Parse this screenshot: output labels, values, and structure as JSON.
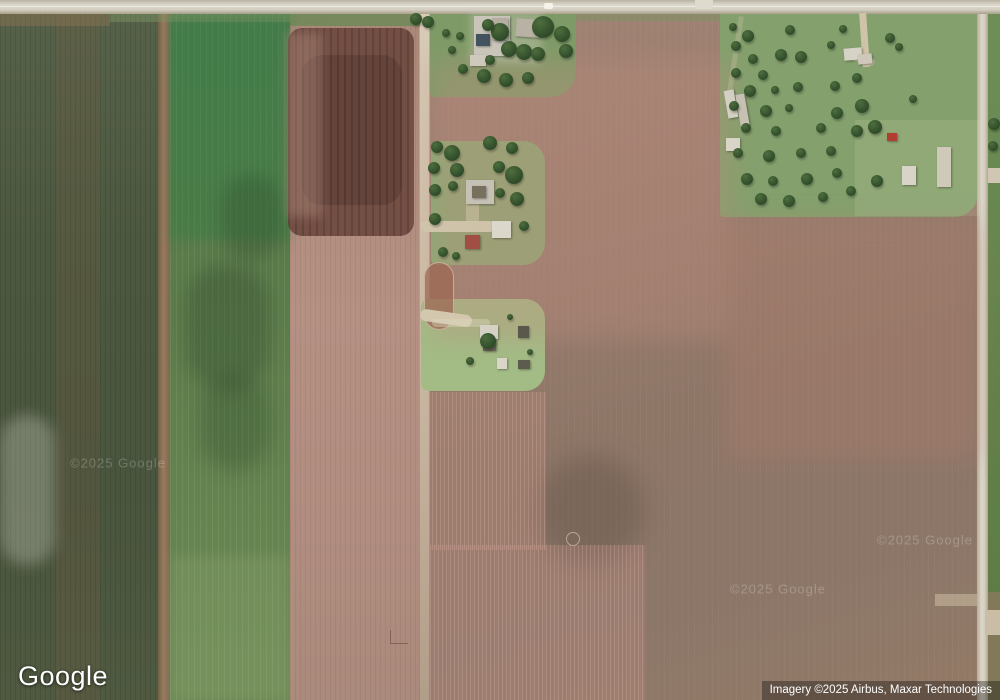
{
  "app": {
    "name": "Google Maps satellite view"
  },
  "branding": {
    "logo_text": "Google"
  },
  "attribution": {
    "text": "Imagery ©2025 Airbus, Maxar Technologies"
  },
  "watermark": {
    "text": "©2025 Google",
    "instances": [
      {
        "x": 118,
        "y": 463
      },
      {
        "x": 778,
        "y": 589
      },
      {
        "x": 925,
        "y": 540
      }
    ]
  },
  "palette": {
    "dark_green_field": "#4c583f",
    "bright_green_field": "#4e7b4e",
    "pink_tilled_field": "#b59184",
    "dark_tilled_patch": "#6f4a40",
    "big_brown_field": "#8e7667",
    "pasture_green": "#84a06d",
    "lawn_green": "#8caa74",
    "road_gray": "#d3cec0",
    "tree_green": "#2e4a28",
    "red_barn": "#a14f45",
    "attribution_bg": "rgba(0,0,0,0.33)",
    "text_white": "#ffffff"
  },
  "scene": {
    "patches": [
      {
        "name": "top-road-margin-brown",
        "x": 0,
        "y": 14,
        "w": 110,
        "h": 12,
        "color": "rgba(150,120,85,.40)"
      },
      {
        "name": "top-road-margin-green",
        "x": 110,
        "y": 14,
        "w": 190,
        "h": 8,
        "color": "rgba(125,150,100,.45)"
      },
      {
        "name": "field-c-top-green-strip",
        "x": 290,
        "y": 14,
        "w": 130,
        "h": 12,
        "color": "rgba(108,138,86,.8)"
      },
      {
        "name": "field-d-top-green-strip",
        "x": 576,
        "y": 14,
        "w": 144,
        "h": 7,
        "color": "rgba(120,148,95,.5)"
      },
      {
        "name": "cloud-smudge",
        "x": 0,
        "y": 415,
        "w": 55,
        "h": 150,
        "color": "rgba(230,235,220,.28)",
        "radius": 40,
        "blur": 7
      },
      {
        "name": "field-b-bright-top",
        "x": 170,
        "y": 20,
        "w": 120,
        "h": 220,
        "color": "rgba(44,125,66,.35)",
        "blur": 5
      },
      {
        "name": "field-b-dark-blotch",
        "x": 185,
        "y": 265,
        "w": 85,
        "h": 125,
        "color": "rgba(35,60,35,.30)",
        "radius": 40,
        "blur": 9
      },
      {
        "name": "field-b-dark-blotch",
        "x": 200,
        "y": 375,
        "w": 70,
        "h": 95,
        "color": "rgba(35,60,35,.26)",
        "radius": 40,
        "blur": 9
      },
      {
        "name": "field-b-dark-blotch",
        "x": 222,
        "y": 175,
        "w": 60,
        "h": 85,
        "color": "rgba(35,60,35,.25)",
        "radius": 40,
        "blur": 8
      },
      {
        "name": "field-b-pale-bottom",
        "x": 170,
        "y": 555,
        "w": 120,
        "h": 145,
        "color": "rgba(190,200,150,.14)",
        "blur": 6
      },
      {
        "name": "dark-tilled-patch",
        "x": 288,
        "y": 28,
        "w": 126,
        "h": 208,
        "color": "#6f4a40",
        "radius": 14,
        "opacity": 0.92,
        "cls": "streaksDark"
      },
      {
        "name": "dark-tilled-patch-core",
        "x": 302,
        "y": 55,
        "w": 100,
        "h": 150,
        "color": "#5c3d36",
        "radius": 20,
        "opacity": 0.6,
        "cls": "streaksDark"
      },
      {
        "name": "dark-patch-left-blend",
        "x": 286,
        "y": 32,
        "w": 36,
        "h": 185,
        "color": "rgba(179,144,131,.40)",
        "blur": 5
      },
      {
        "name": "field-d-pink-topleft",
        "x": 432,
        "y": 60,
        "w": 300,
        "h": 280,
        "color": "rgba(190,140,124,.33)",
        "blur": 12
      },
      {
        "name": "field-d-red-right",
        "x": 725,
        "y": 220,
        "w": 255,
        "h": 240,
        "color": "rgba(178,126,110,.30)",
        "blur": 12
      },
      {
        "name": "field-d-dark-smudge",
        "x": 535,
        "y": 455,
        "w": 110,
        "h": 110,
        "color": "rgba(60,48,42,.22)",
        "radius": 55,
        "blur": 12
      },
      {
        "name": "field-d-circle-mark",
        "x": 566,
        "y": 532,
        "w": 14,
        "h": 14,
        "color": "transparent",
        "radius": 7,
        "cls": "ringLight"
      },
      {
        "name": "field-d-pink-rows-bottom",
        "x": 430,
        "y": 545,
        "w": 215,
        "h": 155,
        "color": "rgba(200,152,140,.22)",
        "cls": "pinkRows"
      },
      {
        "name": "field-d-pink-rows-mid",
        "x": 428,
        "y": 392,
        "w": 118,
        "h": 158,
        "color": "rgba(190,145,132,.26)",
        "cls": "pinkRows"
      },
      {
        "name": "pasture-light-right",
        "x": 855,
        "y": 120,
        "w": 125,
        "h": 96,
        "color": "rgba(255,255,220,.10)"
      },
      {
        "name": "right-sliver-bottom-brown",
        "x": 988,
        "y": 592,
        "w": 12,
        "h": 108,
        "color": "rgba(135,121,92,.85)"
      },
      {
        "name": "h2-red-dirt-patch",
        "x": 424,
        "y": 262,
        "w": 30,
        "h": 68,
        "color": "rgba(158,104,84,.75)",
        "radius": 15,
        "cls": "ringLight"
      },
      {
        "name": "l-shaped-mark",
        "x": 390,
        "y": 630,
        "w": 18,
        "h": 14,
        "color": "transparent",
        "cls": "lmark"
      },
      {
        "name": "road-junction-stub",
        "x": 695,
        "y": 0,
        "w": 18,
        "h": 9,
        "color": "#dedacd"
      },
      {
        "name": "east-road-branch-left",
        "x": 935,
        "y": 594,
        "w": 42,
        "h": 12,
        "color": "rgba(205,190,165,.55)"
      },
      {
        "name": "east-road-driveway-upper",
        "x": 988,
        "y": 168,
        "w": 12,
        "h": 15,
        "color": "#cfc7b4"
      },
      {
        "name": "east-road-driveway-lower",
        "x": 985,
        "y": 610,
        "w": 15,
        "h": 25,
        "color": "#c9bda6"
      },
      {
        "name": "vehicle-on-road",
        "x": 544,
        "y": 3,
        "w": 9,
        "h": 6,
        "color": "#f5f3ea",
        "radius": 2
      },
      {
        "name": "pasture-trail",
        "x": 733,
        "y": 16,
        "w": 5,
        "h": 76,
        "color": "rgba(200,190,160,.35)",
        "rot": 9
      },
      {
        "name": "pasture-driveway",
        "x": 861,
        "y": 13,
        "w": 7,
        "h": 54,
        "color": "#cfc4a8",
        "rot": -4
      },
      {
        "name": "pasture-driveway-spur",
        "x": 848,
        "y": 55,
        "w": 27,
        "h": 8,
        "color": "rgba(207,196,168,.8)",
        "rot": 18,
        "radius": 4
      },
      {
        "name": "h1-ground-patch",
        "x": 470,
        "y": 12,
        "w": 72,
        "h": 52,
        "color": "rgba(212,207,192,.35)",
        "blur": 4
      },
      {
        "name": "h2-driveway",
        "x": 420,
        "y": 221,
        "w": 75,
        "h": 11,
        "color": "#cfc3a9",
        "radius": 6
      },
      {
        "name": "h2-driveway-vert",
        "x": 466,
        "y": 196,
        "w": 13,
        "h": 30,
        "color": "rgba(205,193,165,.55)",
        "radius": 4
      },
      {
        "name": "h3-driveway",
        "x": 420,
        "y": 312,
        "w": 52,
        "h": 12,
        "color": "#d3c8ae",
        "radius": 8,
        "rot": 8
      },
      {
        "name": "h3-driveway-streak",
        "x": 432,
        "y": 319,
        "w": 58,
        "h": 8,
        "color": "rgba(222,217,192,.40)",
        "radius": 4
      }
    ],
    "buildings": [
      {
        "x": 474,
        "y": 16,
        "w": 36,
        "h": 40,
        "color": "#c9c5b9"
      },
      {
        "x": 492,
        "y": 18,
        "w": 16,
        "h": 22,
        "color": "#b5aea0"
      },
      {
        "x": 476,
        "y": 34,
        "w": 14,
        "h": 12,
        "color": "#42525f"
      },
      {
        "x": 516,
        "y": 19,
        "w": 24,
        "h": 18,
        "color": "#b8b2a4",
        "rot": 4
      },
      {
        "x": 470,
        "y": 55,
        "w": 16,
        "h": 11,
        "color": "#cfc9bb"
      },
      {
        "x": 466,
        "y": 180,
        "w": 28,
        "h": 24,
        "color": "#c6c1b5"
      },
      {
        "x": 472,
        "y": 186,
        "w": 14,
        "h": 12,
        "color": "#77705f"
      },
      {
        "x": 492,
        "y": 221,
        "w": 19,
        "h": 17,
        "color": "#dbd7cb"
      },
      {
        "x": 465,
        "y": 235,
        "w": 15,
        "h": 14,
        "color": "#a14f45"
      },
      {
        "x": 480,
        "y": 325,
        "w": 18,
        "h": 14,
        "color": "#d5d1c5"
      },
      {
        "x": 483,
        "y": 339,
        "w": 13,
        "h": 12,
        "color": "#6b6458"
      },
      {
        "x": 497,
        "y": 358,
        "w": 10,
        "h": 11,
        "color": "#d9d5c9"
      },
      {
        "x": 518,
        "y": 326,
        "w": 11,
        "h": 12,
        "color": "#5a574b"
      },
      {
        "x": 518,
        "y": 360,
        "w": 12,
        "h": 9,
        "color": "#5d5a4e"
      },
      {
        "x": 726,
        "y": 90,
        "w": 10,
        "h": 28,
        "color": "#d3cfc3",
        "rot": -10
      },
      {
        "x": 738,
        "y": 94,
        "w": 9,
        "h": 32,
        "color": "#c6c1b3",
        "rot": -10
      },
      {
        "x": 726,
        "y": 138,
        "w": 14,
        "h": 13,
        "color": "#d8d4c8"
      },
      {
        "x": 844,
        "y": 48,
        "w": 18,
        "h": 12,
        "color": "#d6d2c6",
        "rot": -5
      },
      {
        "x": 858,
        "y": 54,
        "w": 14,
        "h": 10,
        "color": "#cdc8ba",
        "rot": -5
      },
      {
        "x": 902,
        "y": 166,
        "w": 14,
        "h": 19,
        "color": "#d8d4c8"
      },
      {
        "x": 937,
        "y": 147,
        "w": 14,
        "h": 40,
        "color": "#cfc9b8"
      },
      {
        "x": 887,
        "y": 133,
        "w": 10,
        "h": 8,
        "color": "#b23c2e"
      }
    ],
    "trees": [
      [
        543,
        27,
        11
      ],
      [
        562,
        34,
        8
      ],
      [
        500,
        32,
        9
      ],
      [
        488,
        25,
        6
      ],
      [
        509,
        49,
        8
      ],
      [
        524,
        52,
        8
      ],
      [
        538,
        54,
        7
      ],
      [
        566,
        51,
        7
      ],
      [
        484,
        76,
        7
      ],
      [
        506,
        80,
        7
      ],
      [
        528,
        78,
        6
      ],
      [
        416,
        19,
        6
      ],
      [
        428,
        22,
        6
      ],
      [
        446,
        33,
        4
      ],
      [
        460,
        36,
        4
      ],
      [
        452,
        50,
        4
      ],
      [
        463,
        69,
        5
      ],
      [
        490,
        60,
        5
      ],
      [
        437,
        147,
        6
      ],
      [
        452,
        153,
        8
      ],
      [
        490,
        143,
        7
      ],
      [
        512,
        148,
        6
      ],
      [
        434,
        168,
        6
      ],
      [
        457,
        170,
        7
      ],
      [
        435,
        190,
        6
      ],
      [
        453,
        186,
        5
      ],
      [
        499,
        167,
        6
      ],
      [
        514,
        175,
        9
      ],
      [
        517,
        199,
        7
      ],
      [
        435,
        219,
        6
      ],
      [
        443,
        252,
        5
      ],
      [
        456,
        256,
        4
      ],
      [
        500,
        193,
        5
      ],
      [
        524,
        226,
        5
      ],
      [
        488,
        341,
        8
      ],
      [
        470,
        361,
        4
      ],
      [
        510,
        317,
        3
      ],
      [
        530,
        352,
        3
      ],
      [
        733,
        27,
        4
      ],
      [
        748,
        36,
        6
      ],
      [
        790,
        30,
        5
      ],
      [
        736,
        46,
        5
      ],
      [
        781,
        55,
        6
      ],
      [
        753,
        59,
        5
      ],
      [
        801,
        57,
        6
      ],
      [
        736,
        73,
        5
      ],
      [
        763,
        75,
        5
      ],
      [
        831,
        45,
        4
      ],
      [
        843,
        29,
        4
      ],
      [
        798,
        87,
        5
      ],
      [
        750,
        91,
        6
      ],
      [
        775,
        90,
        4
      ],
      [
        835,
        86,
        5
      ],
      [
        857,
        78,
        5
      ],
      [
        734,
        106,
        5
      ],
      [
        766,
        111,
        6
      ],
      [
        789,
        108,
        4
      ],
      [
        837,
        113,
        6
      ],
      [
        862,
        106,
        7
      ],
      [
        746,
        128,
        5
      ],
      [
        776,
        131,
        5
      ],
      [
        821,
        128,
        5
      ],
      [
        857,
        131,
        6
      ],
      [
        738,
        153,
        5
      ],
      [
        769,
        156,
        6
      ],
      [
        801,
        153,
        5
      ],
      [
        831,
        151,
        5
      ],
      [
        747,
        179,
        6
      ],
      [
        773,
        181,
        5
      ],
      [
        807,
        179,
        6
      ],
      [
        837,
        173,
        5
      ],
      [
        761,
        199,
        6
      ],
      [
        789,
        201,
        6
      ],
      [
        823,
        197,
        5
      ],
      [
        851,
        191,
        5
      ],
      [
        877,
        181,
        6
      ],
      [
        890,
        38,
        5
      ],
      [
        899,
        47,
        4
      ],
      [
        875,
        127,
        7
      ],
      [
        913,
        99,
        4
      ],
      [
        994,
        124,
        6
      ],
      [
        993,
        146,
        5
      ]
    ]
  }
}
